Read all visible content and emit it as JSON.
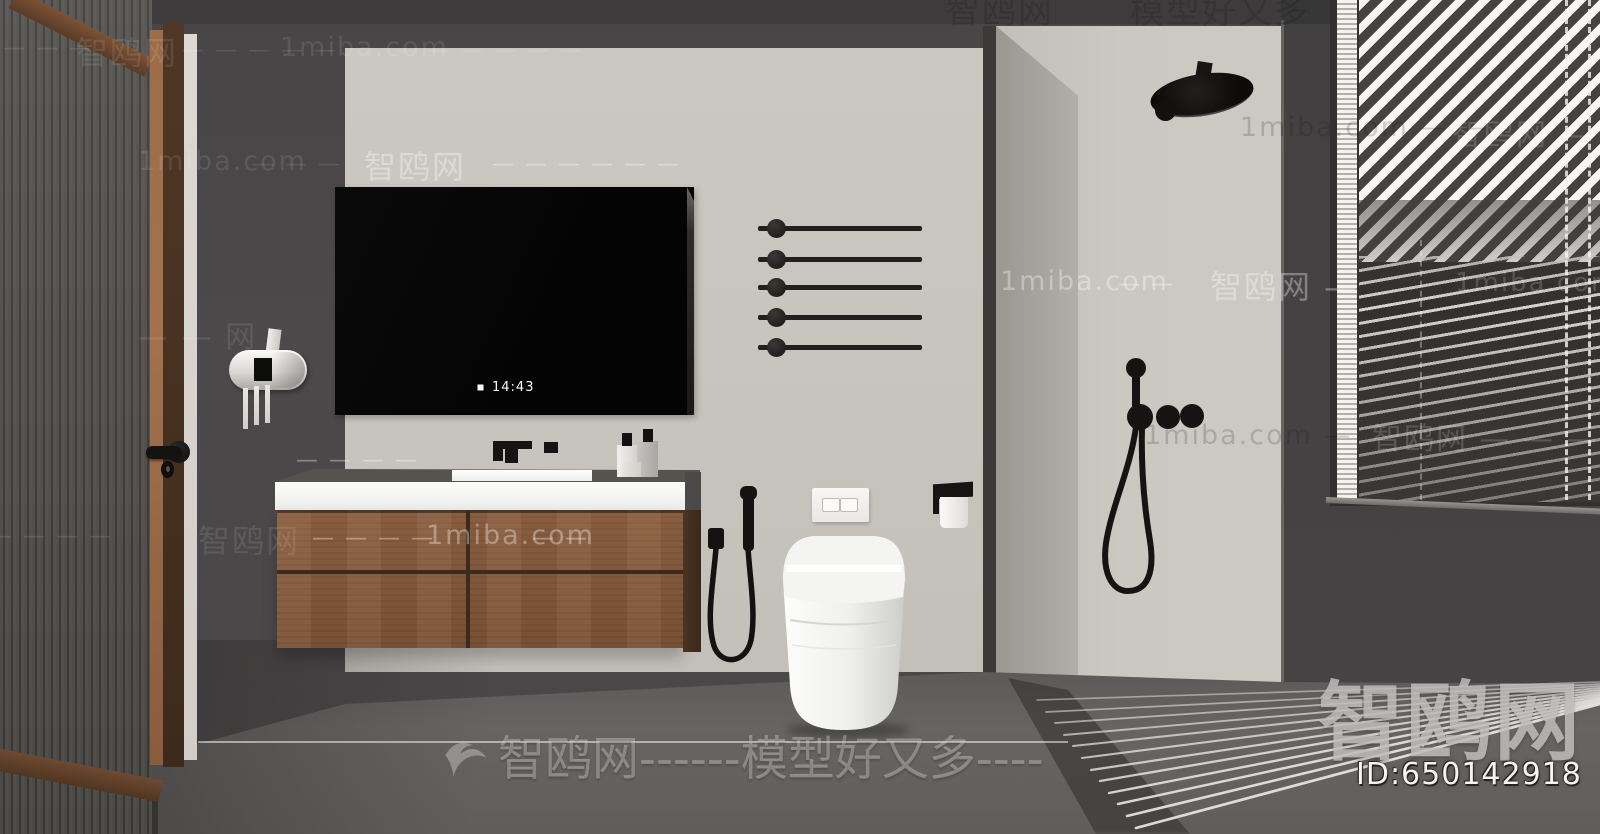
{
  "mirror_display": {
    "time": "14:43",
    "status_icon": "stop-square-icon"
  },
  "brand_badge": {
    "site_name": "智鸥网",
    "model_id": "ID:650142918"
  },
  "watermarks": {
    "site_name": "智鸥网",
    "site_domain": "1miba.com",
    "tagline": "模型好又多",
    "bird_icon": "seagull-icon",
    "center_text": "智鸥网------模型好又多----",
    "tokens": [
      {
        "t": "智鸥网",
        "x": 946,
        "y": -16,
        "fs": 34,
        "c": "D"
      },
      {
        "t": "模型好又多",
        "x": 1130,
        "y": -16,
        "fs": 34,
        "c": "D"
      },
      {
        "t": "— — — —",
        "x": -30,
        "y": 36,
        "fs": 22,
        "c": "L"
      },
      {
        "t": "智鸥网",
        "x": 76,
        "y": 28,
        "fs": 32,
        "c": "L"
      },
      {
        "t": "— — — — —",
        "x": 182,
        "y": 38,
        "fs": 22,
        "c": "L"
      },
      {
        "t": "1miba.com",
        "x": 280,
        "y": 32,
        "fs": 27,
        "c": "L"
      },
      {
        "t": "— — — — — —",
        "x": 395,
        "y": 38,
        "fs": 22,
        "c": "L"
      },
      {
        "t": "1miba.com",
        "x": 138,
        "y": 146,
        "fs": 27,
        "c": "L"
      },
      {
        "t": "— — —",
        "x": 252,
        "y": 152,
        "fs": 22,
        "c": "L"
      },
      {
        "t": "智鸥网",
        "x": 364,
        "y": 142,
        "fs": 32,
        "c": "P"
      },
      {
        "t": "— — — — — —",
        "x": 492,
        "y": 152,
        "fs": 22,
        "c": "P"
      },
      {
        "t": "1miba.com — —",
        "x": 1240,
        "y": 112,
        "fs": 27,
        "c": "D"
      },
      {
        "t": "智鸥网 — —",
        "x": 1452,
        "y": 110,
        "fs": 30,
        "c": "L2"
      },
      {
        "t": "1miba.com",
        "x": 1000,
        "y": 266,
        "fs": 27,
        "c": "P"
      },
      {
        "t": "— —",
        "x": 1118,
        "y": 272,
        "fs": 22,
        "c": "P"
      },
      {
        "t": "智鸥网 —",
        "x": 1210,
        "y": 262,
        "fs": 32,
        "c": "P"
      },
      {
        "t": "1miba.com",
        "x": 1455,
        "y": 268,
        "fs": 26,
        "c": "L2"
      },
      {
        "t": "— — 网",
        "x": 138,
        "y": 312,
        "fs": 30,
        "c": "L"
      },
      {
        "t": "— — — —",
        "x": 296,
        "y": 448,
        "fs": 22,
        "c": "P"
      },
      {
        "t": "1miba.com —",
        "x": 1144,
        "y": 420,
        "fs": 27,
        "c": "D"
      },
      {
        "t": "智鸥网 — — —",
        "x": 1372,
        "y": 414,
        "fs": 30,
        "c": "L2"
      },
      {
        "t": "— — — —",
        "x": -10,
        "y": 524,
        "fs": 22,
        "c": "L"
      },
      {
        "t": "智鸥网",
        "x": 198,
        "y": 516,
        "fs": 32,
        "c": "L"
      },
      {
        "t": "— — — —",
        "x": 312,
        "y": 526,
        "fs": 22,
        "c": "P"
      },
      {
        "t": "1miba.com",
        "x": 426,
        "y": 520,
        "fs": 27,
        "c": "P"
      },
      {
        "t": "— —",
        "x": 532,
        "y": 526,
        "fs": 22,
        "c": "P"
      }
    ]
  },
  "colors": {
    "wall_dark": "#4a4848",
    "panel_light": "#c8c5bf",
    "wood_cabinet": "#875c3e",
    "floor": "#646260",
    "fixture_black": "#161514",
    "toilet_white": "#f7f7f5"
  }
}
